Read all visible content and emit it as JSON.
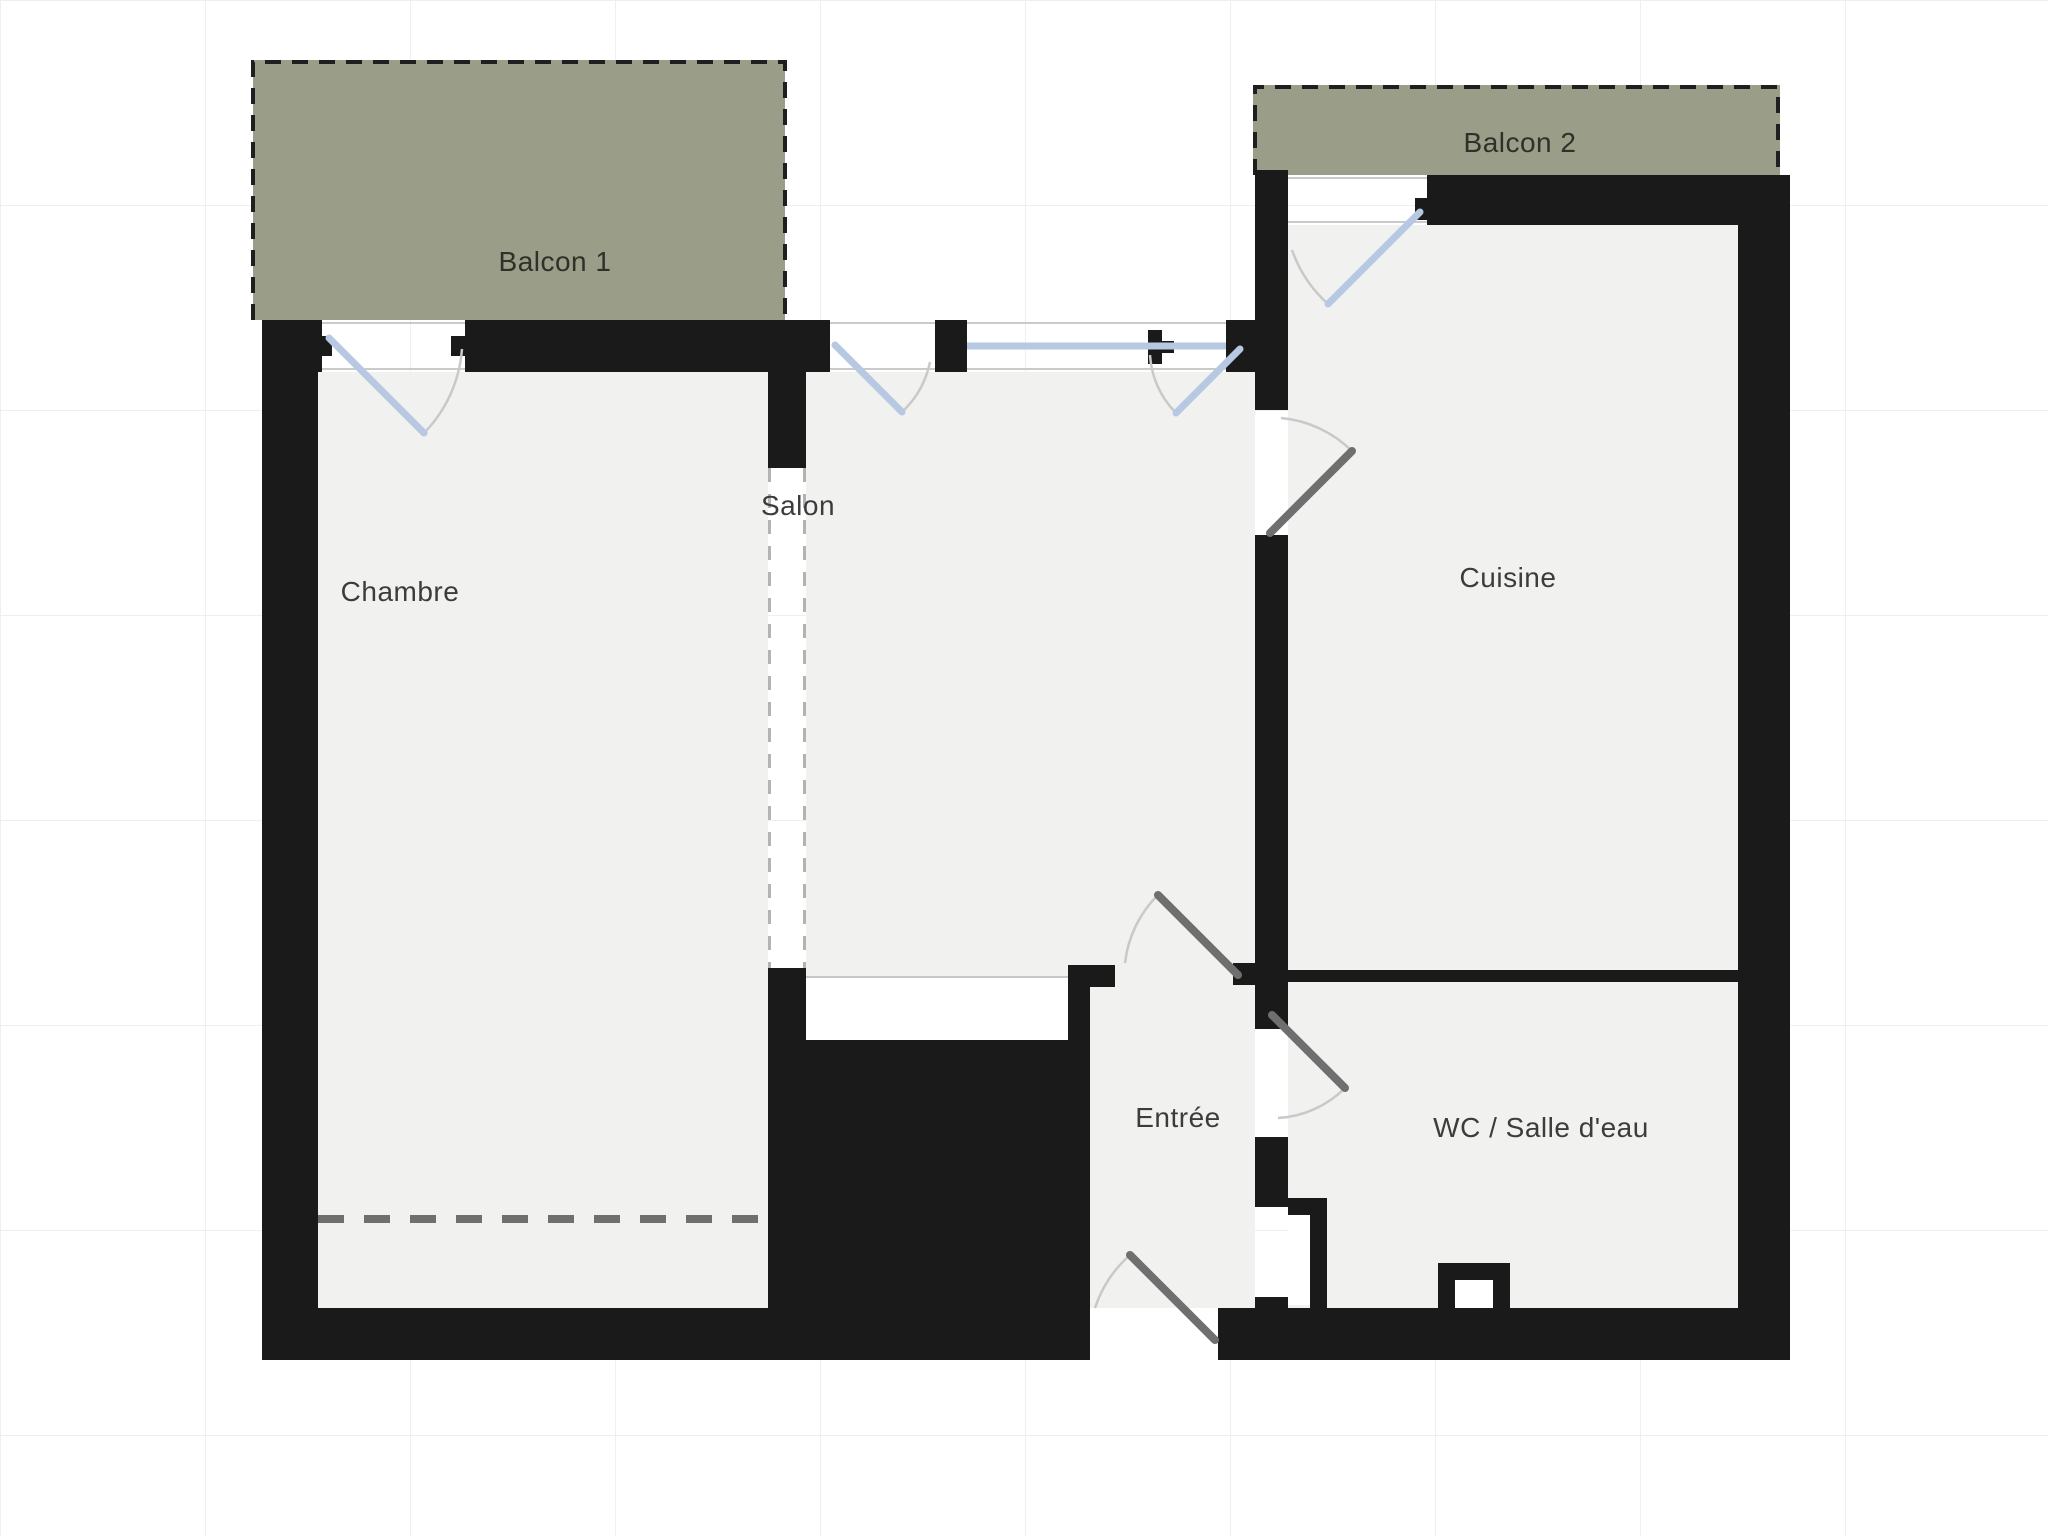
{
  "plan": {
    "type": "apartment-floor-plan",
    "rooms": {
      "balcony1": {
        "label": "Balcon 1"
      },
      "balcony2": {
        "label": "Balcon 2"
      },
      "bedroom": {
        "label": "Chambre"
      },
      "living": {
        "label": "Salon"
      },
      "kitchen": {
        "label": "Cuisine"
      },
      "entry": {
        "label": "Entrée"
      },
      "bathroom": {
        "label": "WC / Salle d'eau"
      }
    }
  },
  "colors": {
    "wall": "#1a1a1a",
    "room": "#f1f1ef",
    "opening": "#ffffff",
    "balcony": "#9a9d87",
    "balconyDash": "#1f1f1f",
    "window": "#b7c8e2",
    "doorExterior": "#b7c8e2",
    "doorInterior": "#6f6f6f",
    "arc": "#c9c9c9",
    "sill": "#cacaca",
    "floorLine": "#c7c7c7",
    "dashedOpen": "#b3b3b3",
    "dashedFurniture": "#6f6f6f",
    "grid": "#efefef",
    "label": "#3c3c3c",
    "balconyLabel": "#30302a",
    "background": "#ffffff"
  }
}
